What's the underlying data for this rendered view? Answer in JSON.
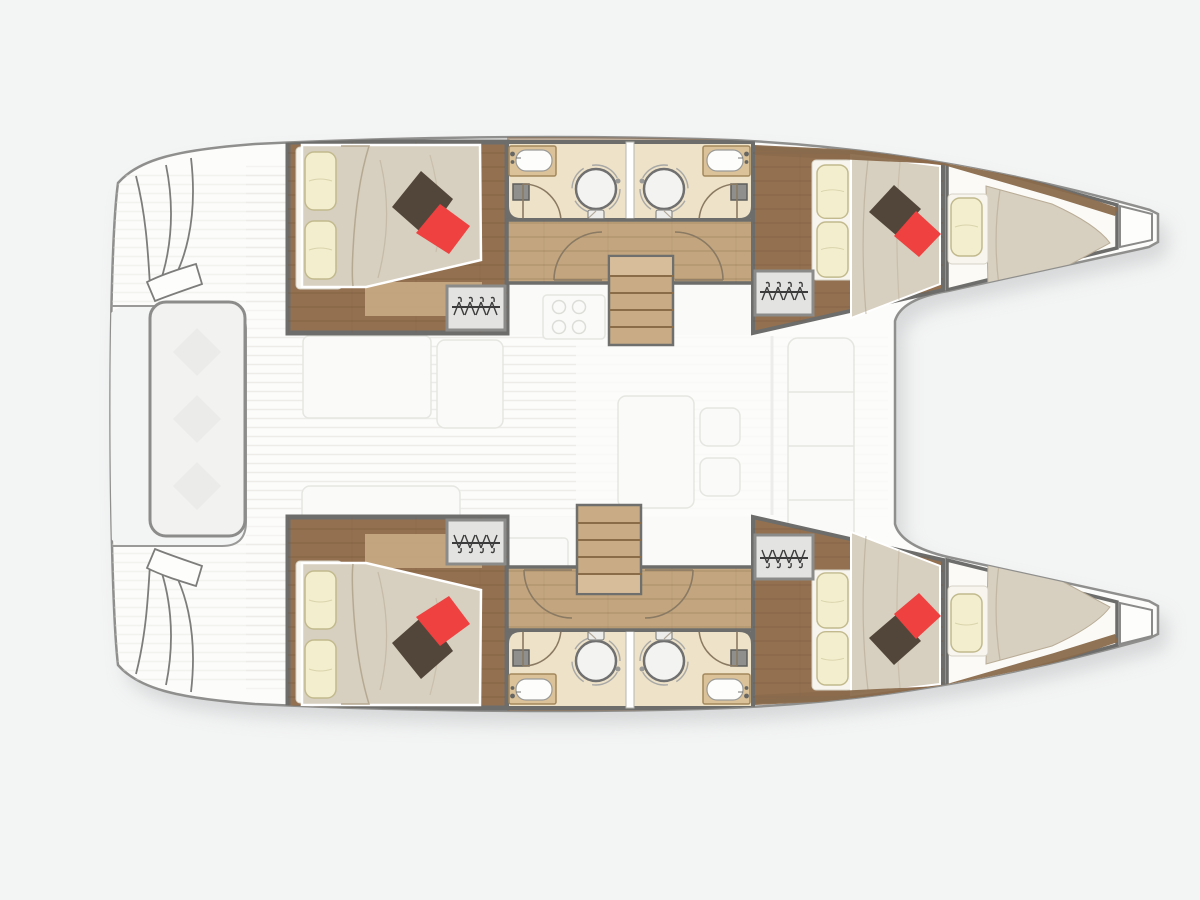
{
  "meta": {
    "description": "Catamaran yacht interior floor plan, top-down view, bows pointing right, no visible text labels",
    "canvas": {
      "width": 1200,
      "height": 900
    }
  },
  "colors": {
    "bg": "#f0f1f1",
    "shadow": "#b9bcbd",
    "boat": "#fcfcfb",
    "outline": "#8f8f8d",
    "innerBorder": "#6d6d6b",
    "woodFloor": "#937050",
    "plank": "#6f5336",
    "corridor": "#c3a67f",
    "stairs": "#c9ac85",
    "tread": "#8a6c49",
    "landing": "#d9c09c",
    "bath": "#eee2c8",
    "counter": "#dcc298",
    "counterEdge": "#a3885c",
    "mattress": "#d7cfbf",
    "mattressLine": "#b3a78f",
    "sheet": "#f7f5ee",
    "pillowCream": "#f3eecd",
    "pillowCreamEdge": "#c2ba8e",
    "pillowDark": "#52463a",
    "pillowRed": "#ee4140",
    "wardrobe": "#e3e3e1",
    "wardrobeEdge": "#8b8b89",
    "hanger": "#3c3c3c",
    "shower": "#f3f3f1",
    "showerEdge": "#707070",
    "fixture": "#8f8f8d",
    "teak": "#e0dfda",
    "salon": "#fafaf8",
    "salonLine": "#e5e5e1",
    "bench": "#f2f2f0",
    "benchEdge": "#8c8c8a",
    "door": "#8a7a63",
    "trim": "#8a6a4c",
    "notch": "#f3f4f4"
  },
  "diagram": {
    "type": "yacht-floor-plan",
    "vessel_type": "catamaran",
    "view": "top-down",
    "bow_direction": "right",
    "stern_direction": "left",
    "hull_count": 2,
    "double_cabins": 4,
    "forepeak_berths": 2,
    "bathrooms": 4,
    "round_showers": 4,
    "washbasins": 4,
    "wardrobes_with_hangers": 4,
    "companionway_stairs": 2,
    "pillows_per_double_cabin": {
      "cream": 2,
      "dark_brown": 1,
      "red": 1
    },
    "pillows_per_forepeak_berth": {
      "cream": 1
    },
    "salon_items": [
      "cockpit-table",
      "cockpit-benches",
      "galley-stove-4-burners",
      "saloon-table",
      "chairs",
      "sofa"
    ],
    "stern_items": [
      "cockpit-bench",
      "transom-steps-port",
      "transom-steps-starboard"
    ],
    "bow_items": [
      "anchor-locker-port",
      "anchor-locker-starboard"
    ],
    "style": "salon and cockpit drawn faded, cabins drawn in full color"
  }
}
